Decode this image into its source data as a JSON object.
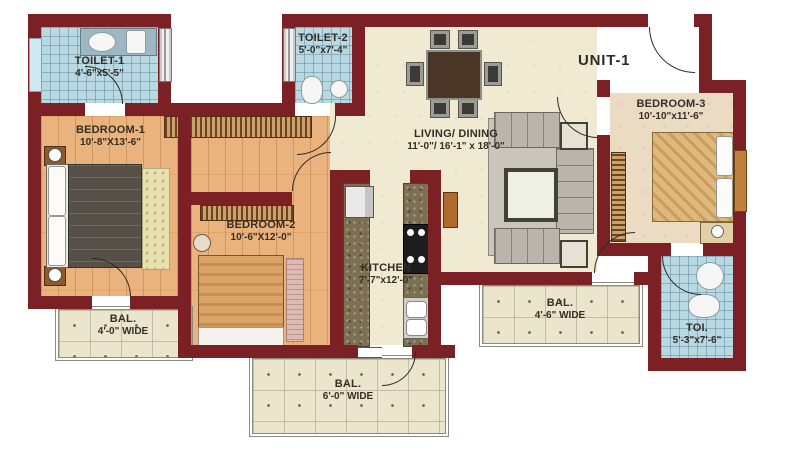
{
  "plan": {
    "unit": "UNIT-1",
    "rooms": {
      "toilet1": {
        "name": "TOILET-1",
        "dims": "4'-6\"x5'-5\""
      },
      "toilet2": {
        "name": "TOILET-2",
        "dims": "5'-0\"x7'-4\""
      },
      "bedroom1": {
        "name": "BEDROOM-1",
        "dims": "10'-8\"X13'-6\""
      },
      "bedroom2": {
        "name": "BEDROOM-2",
        "dims": "10'-6\"X12'-0\""
      },
      "bedroom3": {
        "name": "BEDROOM-3",
        "dims": "10'-10\"x11'-6\""
      },
      "living": {
        "name": "LIVING/ DINING",
        "dims": "11'-0\"/ 16'-1\" x 18'-0\""
      },
      "kitchen": {
        "name": "KITCHEN",
        "dims": "7'-7\"x12'-0\""
      },
      "balcony1": {
        "name": "BAL.",
        "dims": "4'-0\" WIDE"
      },
      "balcony2": {
        "name": "BAL.",
        "dims": "6'-0\" WIDE"
      },
      "balcony3": {
        "name": "BAL.",
        "dims": "4'-6\" WIDE"
      },
      "toi": {
        "name": "TOI.",
        "dims": "5'-3\"x7'-6\""
      }
    },
    "colors": {
      "wall": "#7b2125",
      "wood_floor": "#eab27c",
      "cream_floor": "#f0ead3",
      "blue_tile": "#b8d8e2",
      "balcony_tile": "#ebe5cd",
      "label_text": "#332e26"
    }
  }
}
